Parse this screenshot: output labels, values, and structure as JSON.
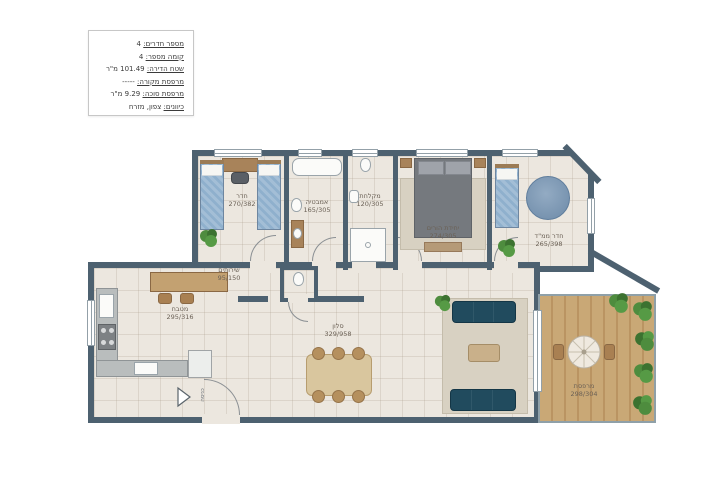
{
  "info_box": {
    "lines": [
      {
        "label": "מספר חדרים:",
        "value": "4"
      },
      {
        "label": "קומה מספר:",
        "value": "4"
      },
      {
        "label": "שטח הדירה:",
        "value": "101.49 מ\"ר"
      },
      {
        "label": "מרפסת מקורה:",
        "value": "-----"
      },
      {
        "label": "מרפסת סוכה:",
        "value": "9.29 מ\"ר"
      },
      {
        "label": "כיוונים:",
        "value": "צפון, מזרח"
      }
    ]
  },
  "rooms": {
    "bedroom": {
      "name": "חדר",
      "dims": "270/382"
    },
    "bathroom": {
      "name": "אמבטיה",
      "dims": "165/305"
    },
    "shower": {
      "name": "מקלחת",
      "dims": "120/305"
    },
    "master_bedroom": {
      "name": "יחידת הורים",
      "dims": "274/305"
    },
    "mamad": {
      "name": "חדר ממ\"ד",
      "dims": "265/398"
    },
    "wc": {
      "name": "שירותים",
      "dims": "95/150"
    },
    "kitchen": {
      "name": "מטבח",
      "dims": "295/316"
    },
    "living_room": {
      "name": "סלון",
      "dims": "329/958"
    },
    "balcony": {
      "name": "מרפסת",
      "dims": "298/304"
    }
  },
  "entrance": {
    "label": "כניסה"
  },
  "colors": {
    "wall": "#4d6170",
    "floor": "#ece7df",
    "wood": "#c9a876",
    "bed_blue": "#8fb0cd",
    "sofa": "#214b5e"
  }
}
